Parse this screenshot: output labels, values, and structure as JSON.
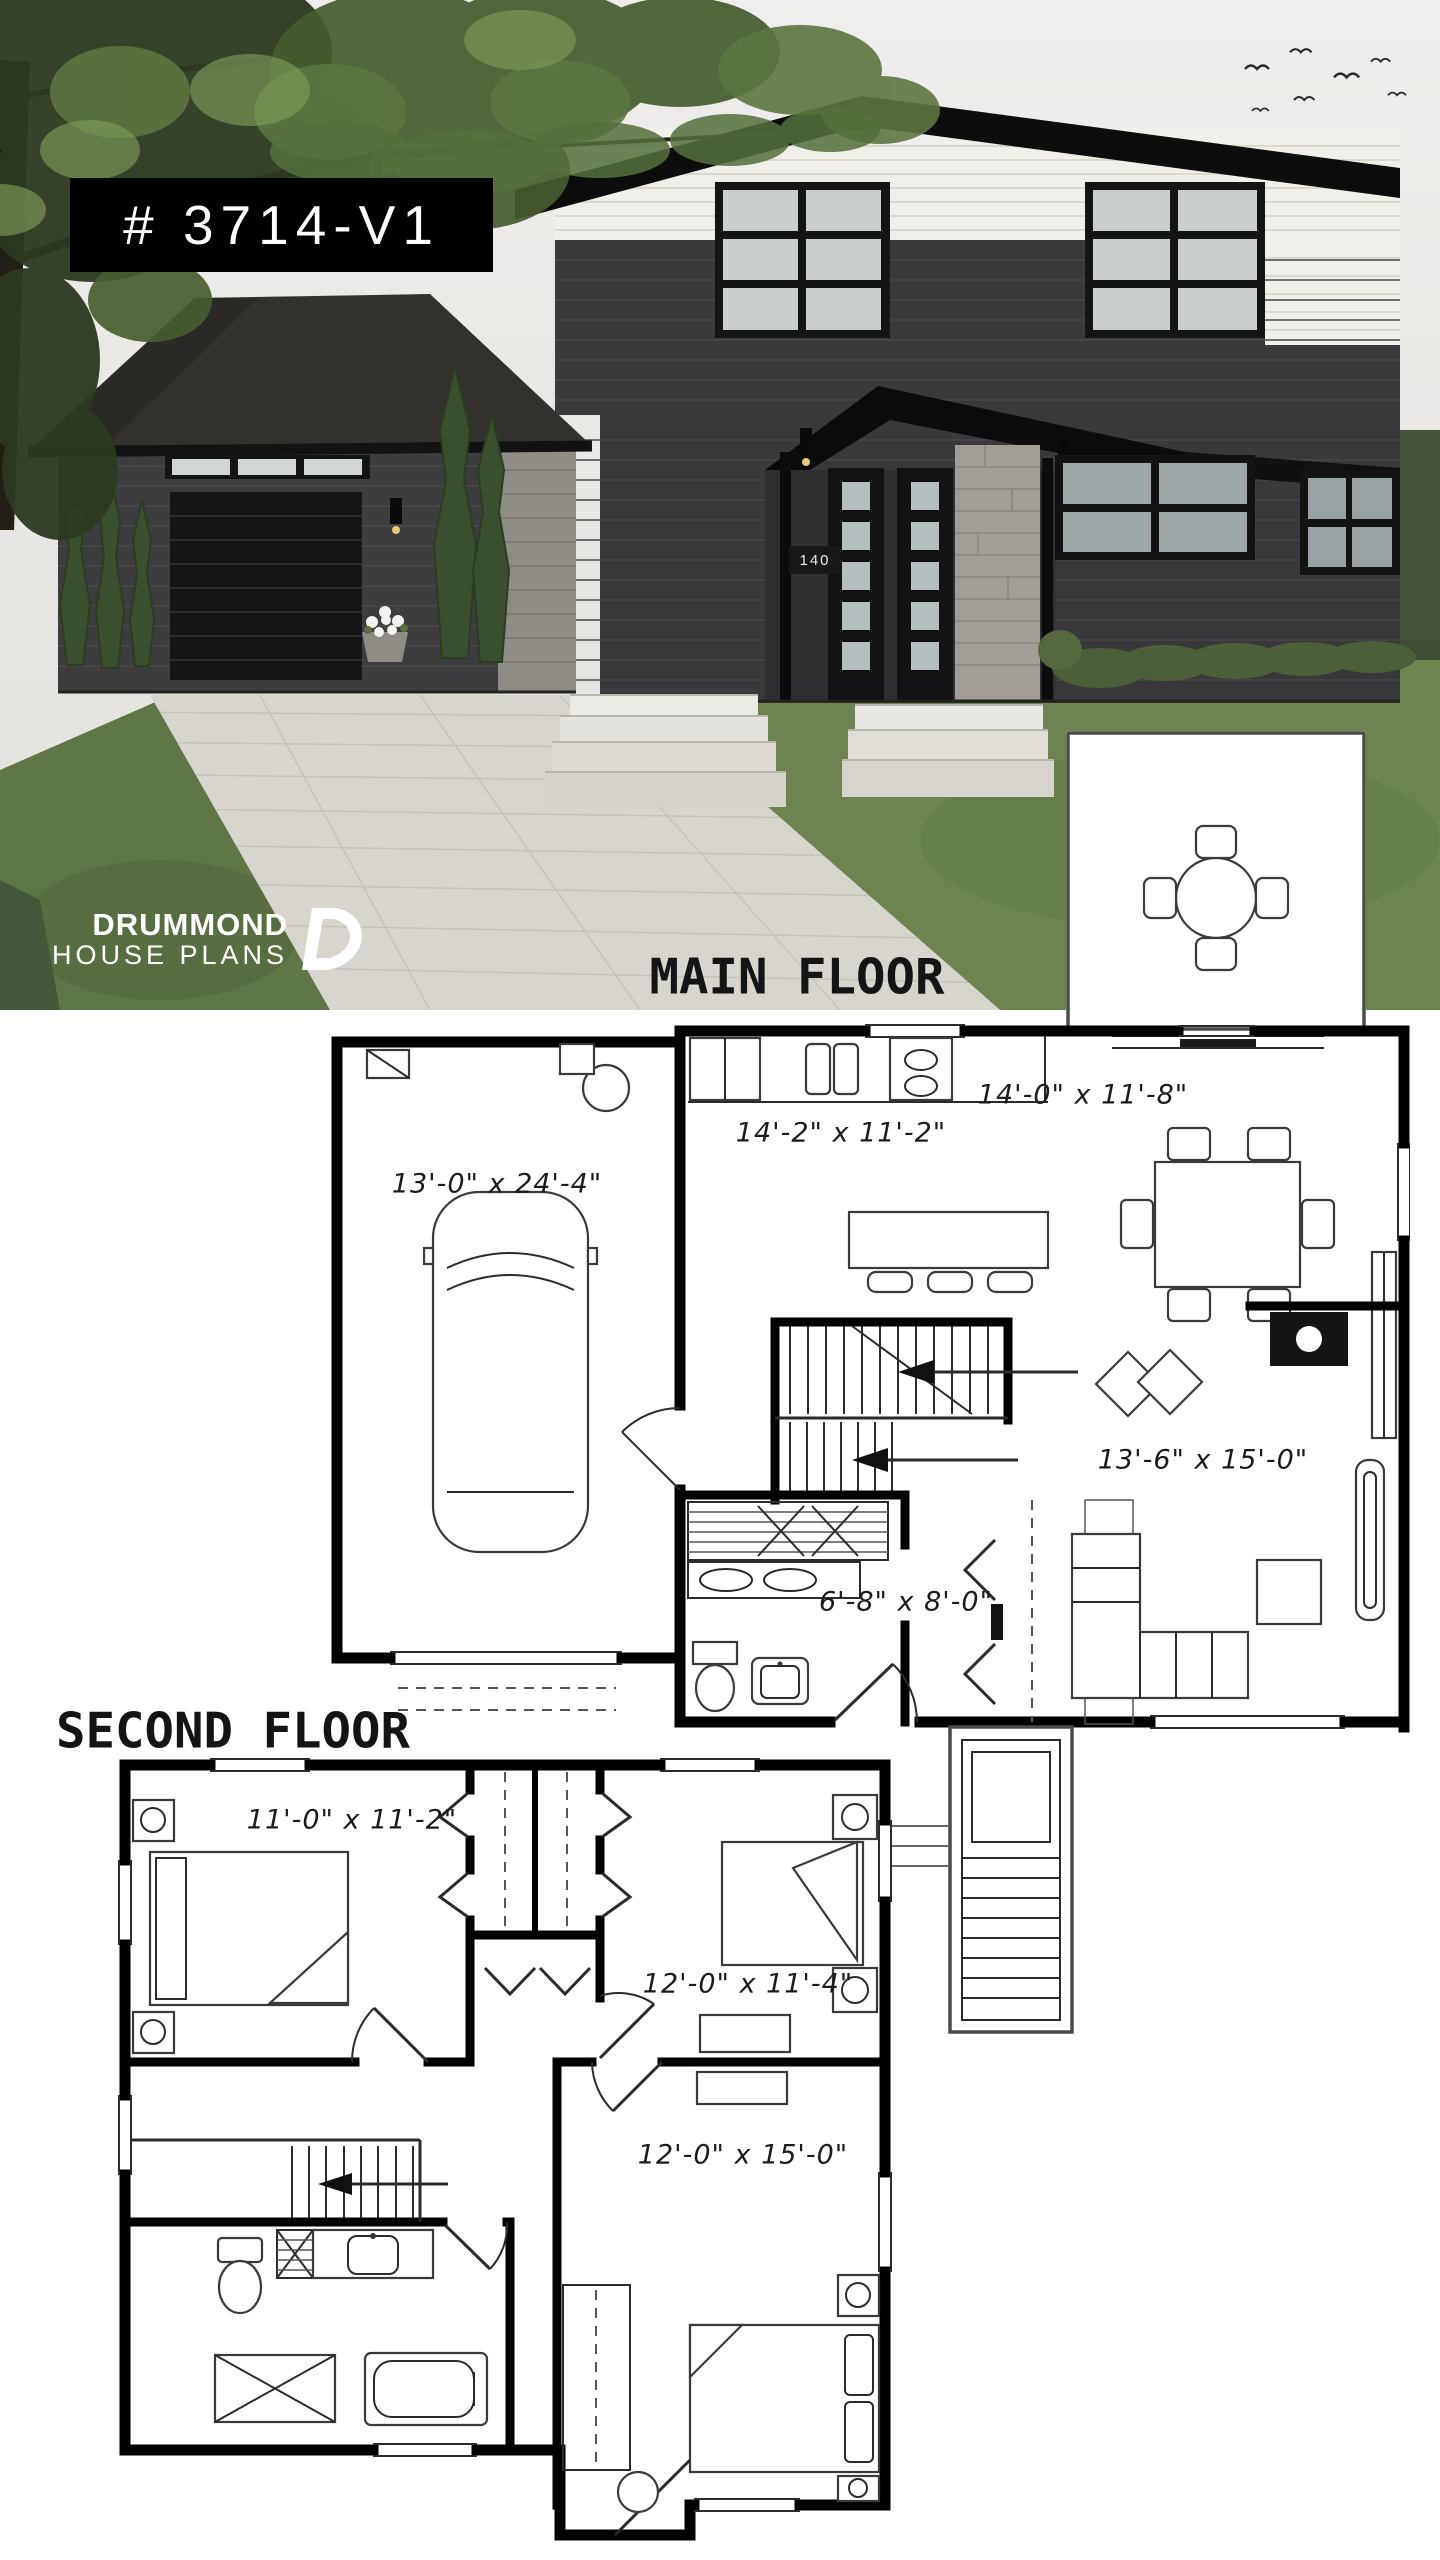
{
  "photo": {
    "plan_badge": "# 3714-V1",
    "house_number": "140",
    "logo": {
      "line1": "DRUMMOND",
      "line2": "HOUSE PLANS"
    }
  },
  "floors": {
    "main": {
      "title": "MAIN FLOOR",
      "rooms": {
        "garage": "13'-0\" x 24'-4\"",
        "kitchen": "14'-2\" x 11'-2\"",
        "dining": "14'-0\" x 11'-8\"",
        "living": "13'-6\" x 15'-0\"",
        "entry": "6'-8\" x 8'-0\""
      }
    },
    "second": {
      "title": "SECOND FLOOR",
      "rooms": {
        "bedroom1": "11'-0\" x 11'-2\"",
        "bedroom2": "12'-0\" x 11'-4\"",
        "master_bedroom": "12'-0\" x 15'-0\""
      }
    }
  },
  "colors": {
    "badge_bg": "#000000",
    "plan_line": "#000000",
    "foliage_green": "#4a5c33",
    "lawn_green": "#67804a",
    "driveway": "#d8d5cf",
    "brick_dark": "#3a3a3c",
    "siding_white": "#f1efe9",
    "sky": "#edecea"
  }
}
